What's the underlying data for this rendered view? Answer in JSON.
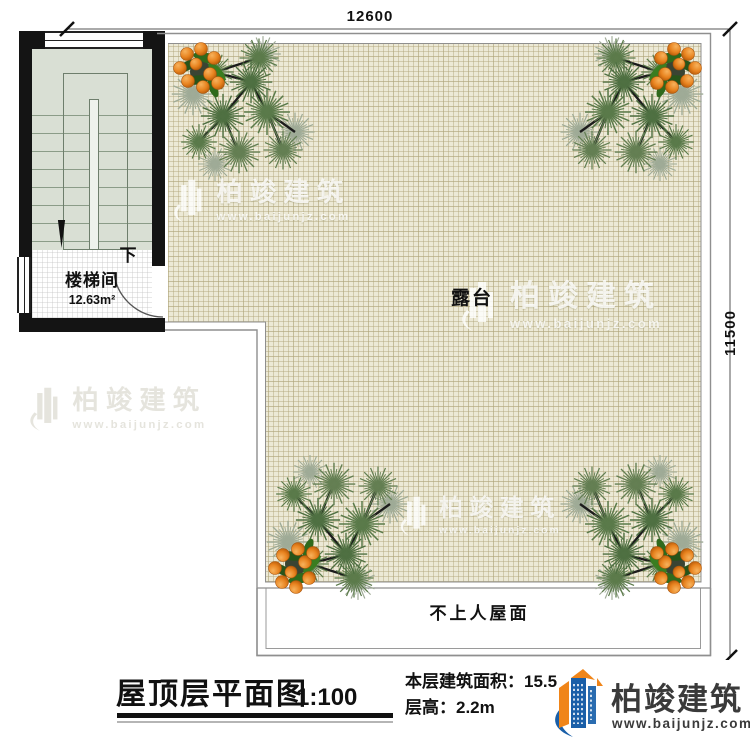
{
  "plan": {
    "dim_top": "12600",
    "dim_right": "11500",
    "terrace_label": "露台",
    "roof_label": "不上人屋面",
    "stair_label": "楼梯间",
    "stair_area": "12.63m²",
    "down_label": "下"
  },
  "titlebar": {
    "title": "屋顶层平面图",
    "scale": "1:100",
    "area_label": "本层建筑面积：",
    "area_value": "15.5",
    "height_label": "层高：",
    "height_value": "2.2m"
  },
  "brand": {
    "name": "柏竣建筑",
    "url": "www.baijunjz.com",
    "blue": "#1a5fa8",
    "orange": "#f08519"
  },
  "colors": {
    "wall": "#141414",
    "terrace_fill": "#ece9d6",
    "grid_line": "#b0a578",
    "stair_fill": "#d9dfd4",
    "outline_gray": "#8f8f8f"
  }
}
